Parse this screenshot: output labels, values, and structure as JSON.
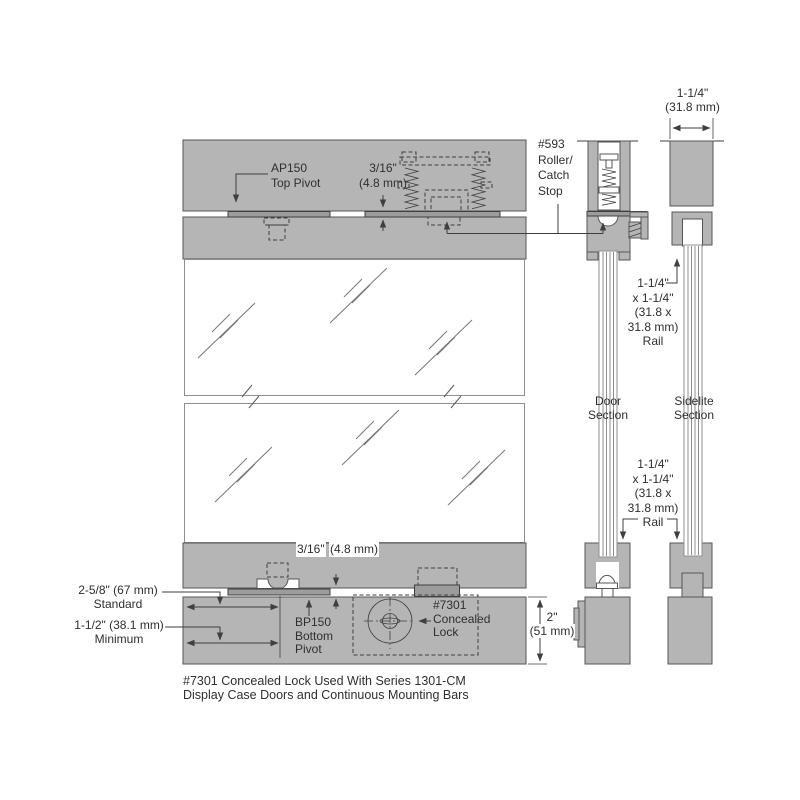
{
  "colors": {
    "band": "#b5b5b5",
    "plate": "#9c9c9c",
    "edge": "#565656",
    "line": "#3f3f3f",
    "text": "#2f2f2f",
    "glass_edge": "#8f8f8f",
    "background": "#ffffff"
  },
  "labels": {
    "top_pivot": {
      "l1": "AP150",
      "l2": "Top Pivot"
    },
    "glass_gap_top": {
      "l1": "3/16\"",
      "l2": "(4.8 mm)"
    },
    "roller_catch_stop": {
      "l1": "#593",
      "l2": "Roller/",
      "l3": "Catch",
      "l4": "Stop"
    },
    "header_width": {
      "l1": "1-1/4\"",
      "l2": "(31.8 mm)"
    },
    "rail_upper": {
      "l1": "1-1/4\"",
      "l2": "x 1-1/4\"",
      "l3": "(31.8 x",
      "l4": "31.8 mm)",
      "l5": "Rail"
    },
    "door_section": {
      "l1": "Door",
      "l2": "Section"
    },
    "sidelite_section": {
      "l1": "Sidelite",
      "l2": "Section"
    },
    "rail_lower": {
      "l1": "1-1/4\"",
      "l2": "x 1-1/4\"",
      "l3": "(31.8 x",
      "l4": "31.8 mm)",
      "l5": "Rail"
    },
    "glass_gap_bottom": {
      "l1": "3/16\"",
      "l2": "(4.8 mm)"
    },
    "standard_height": {
      "l1": "2-5/8\" (67 mm)",
      "l2": "Standard"
    },
    "minimum_height": {
      "l1": "1-1/2\" (38.1 mm)",
      "l2": "Minimum"
    },
    "bottom_pivot": {
      "l1": "BP150",
      "l2": "Bottom",
      "l3": "Pivot"
    },
    "concealed_lock": {
      "l1": "#7301",
      "l2": "Concealed",
      "l3": "Lock"
    },
    "base_height": {
      "l1": "2\"",
      "l2": "(51 mm)"
    },
    "caption": {
      "l1": "#7301 Concealed Lock Used With Series 1301-CM",
      "l2": "Display Case Doors and Continuous Mounting Bars"
    }
  }
}
